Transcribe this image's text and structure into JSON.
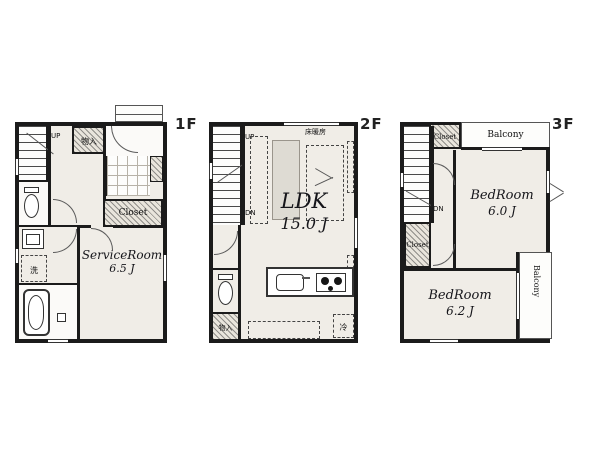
{
  "plan_title": "3-story house floor plan",
  "colors": {
    "wall": "#1b1b1b",
    "room_fill": "#f0ede7",
    "hatch_fill": "#e9e5dc",
    "background": "#ffffff"
  },
  "floors": [
    {
      "label": "1F",
      "stairs_up": "UP",
      "storage": "物入",
      "closet": "Closet",
      "washer": "洗",
      "room_name": "ServiceRoom",
      "room_size": "6.5 J"
    },
    {
      "label": "2F",
      "stairs_up": "UP",
      "stairs_down": "DN",
      "floor_heating": "床暖房",
      "room_name": "LDK",
      "room_size": "15.0 J",
      "storage": "物入",
      "fridge": "冷"
    },
    {
      "label": "3F",
      "stairs_down": "DN",
      "closet_top": "Closet",
      "closet_mid": "Closet",
      "balcony_top": "Balcony",
      "balcony_side": "Balcony",
      "bedroom1_name": "BedRoom",
      "bedroom1_size": "6.0 J",
      "bedroom2_name": "BedRoom",
      "bedroom2_size": "6.2 J"
    }
  ]
}
